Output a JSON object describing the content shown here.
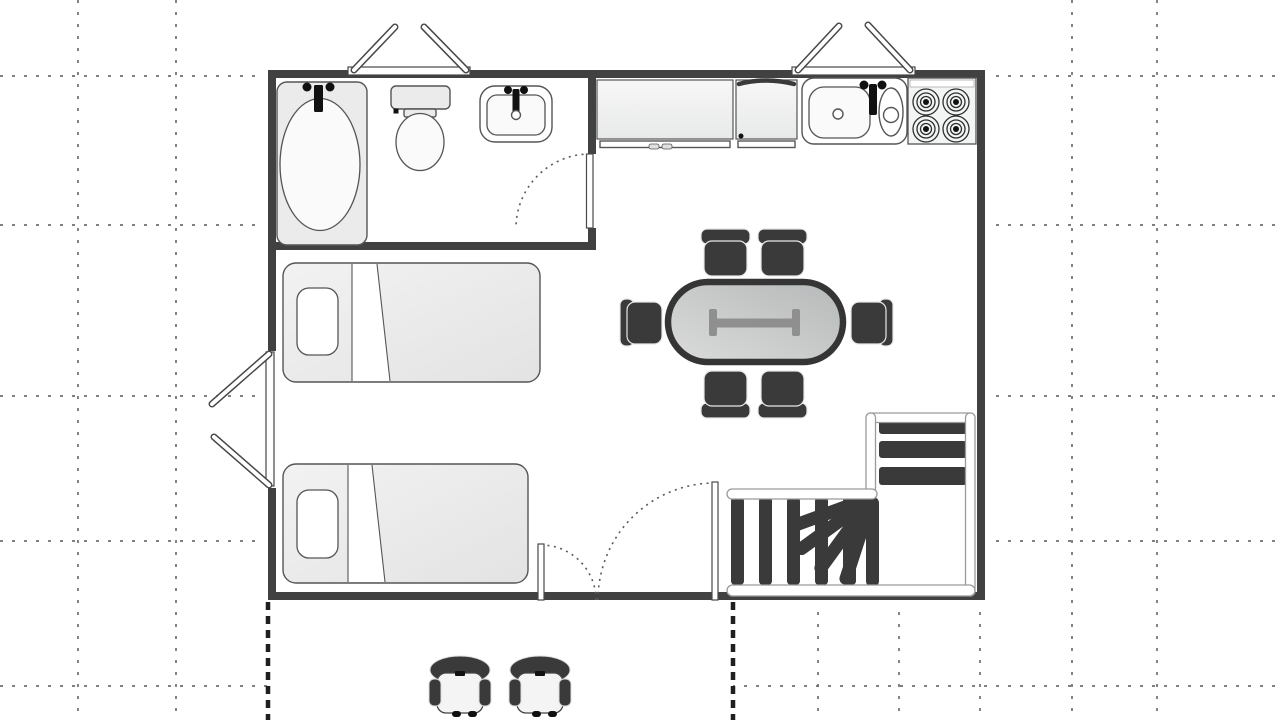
{
  "title": "Studio apartment floor plan",
  "canvas": {
    "width": 1280,
    "height": 720
  },
  "colors": {
    "bg": "#ffffff",
    "grid": "#6e6e6e",
    "heavy": "#1f1f1f",
    "wall": "#414141",
    "line": "#555555",
    "dark": "#3a3a3a",
    "black": "#111111",
    "tableBorder": "#353535",
    "ibeam": "#8f8f8f",
    "stringer": "#9a9a9a",
    "fixture": "#ebebeb"
  },
  "plan": {
    "type": "floor plan, top-down view, no text labels",
    "rooms": [
      {
        "name": "bathroom",
        "position": "top-left",
        "fixtures": [
          "bathtub",
          "toilet",
          "sink"
        ]
      },
      {
        "name": "kitchen",
        "position": "top-right",
        "fixtures": [
          "counter cabinet with two handles",
          "appliance cabinet",
          "double sink with faucet",
          "stove with 4 burners"
        ]
      },
      {
        "name": "living-dining",
        "position": "center",
        "fixtures": [
          "oval dining table with pedestal",
          "6 dark chairs",
          "L-shaped winder staircase"
        ]
      },
      {
        "name": "sleeping area",
        "position": "left",
        "fixtures": [
          "single bed with pillow",
          "single bed with pillow"
        ]
      },
      {
        "name": "terrace",
        "position": "bottom outside, bounded by heavy dashed lines",
        "fixtures": [
          "armchair",
          "armchair"
        ]
      }
    ],
    "doors": [
      {
        "name": "bathroom door",
        "type": "single swing with dashed arc"
      },
      {
        "name": "entry double door",
        "type": "two unequal leaves with dashed arcs"
      }
    ],
    "windows": [
      {
        "name": "top-left window",
        "type": "double casement opening outward"
      },
      {
        "name": "top-right window",
        "type": "double casement opening outward"
      },
      {
        "name": "left window",
        "type": "double casement opening outward"
      }
    ],
    "stairs": {
      "straight_treads_lower": 5,
      "winder_treads": 5,
      "straight_treads_upper": 3
    },
    "grid": {
      "vertical_lines_x": [
        78,
        176,
        1072,
        1157
      ],
      "vertical_lines_below_plan_x": [
        818,
        899,
        980
      ],
      "horizontal_lines_y": [
        76,
        225,
        396,
        541,
        686
      ],
      "terrace_dashed_x": [
        268,
        733
      ]
    }
  }
}
